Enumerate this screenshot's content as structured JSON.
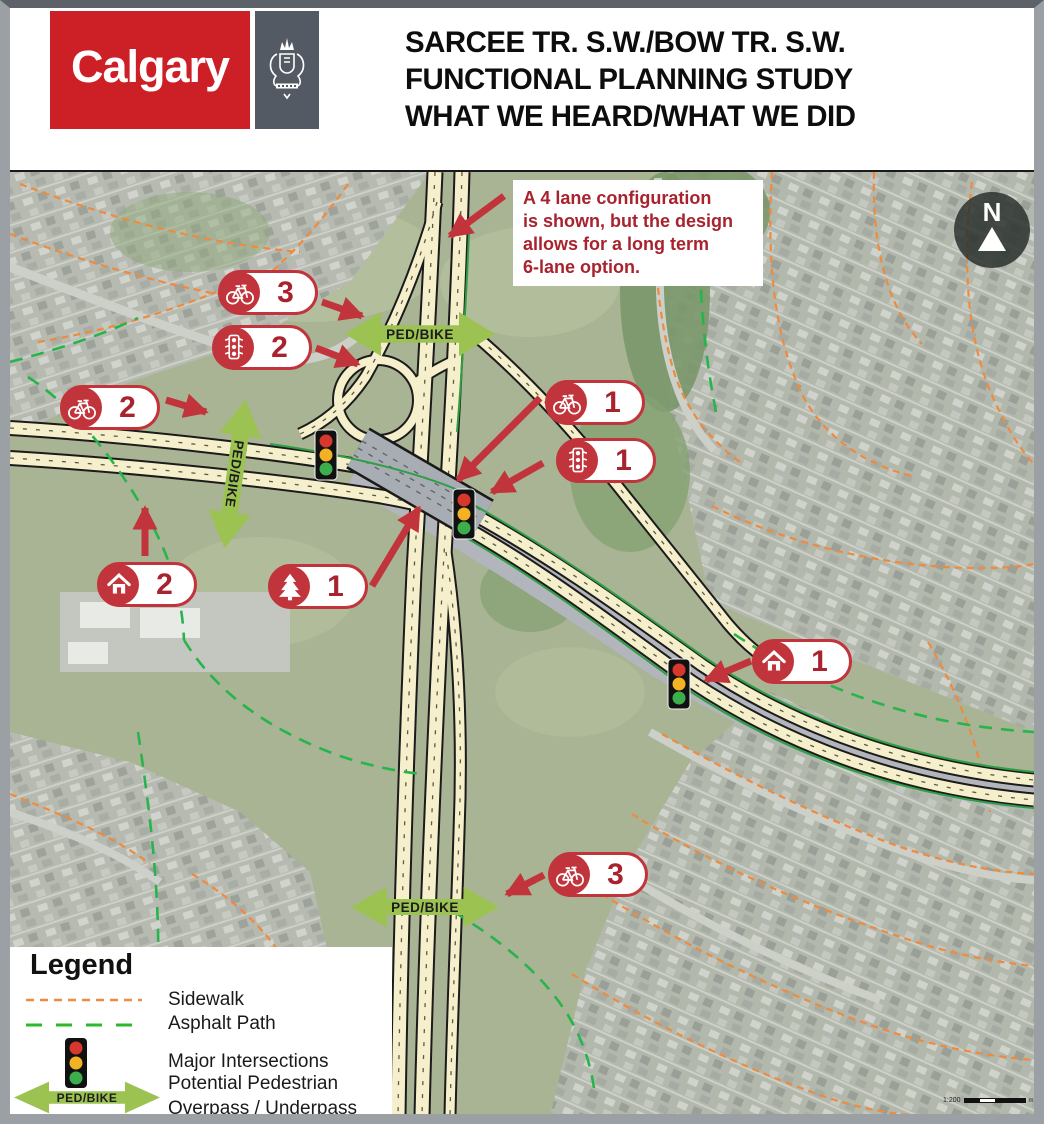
{
  "header": {
    "logo_text": "Calgary",
    "title": "SARCEE TR. S.W./BOW TR. S.W.\nFUNCTIONAL PLANNING STUDY\nWHAT WE HEARD/WHAT WE DID"
  },
  "map": {
    "callout_text": "A 4 lane configuration\nis shown, but the design\nallows for a long term\n6-lane option.",
    "north_label": "N",
    "ped_bike_label": "PED/BIKE",
    "markers": [
      {
        "type": "bike",
        "count": "3"
      },
      {
        "type": "traffic-signal",
        "count": "2"
      },
      {
        "type": "bike",
        "count": "2"
      },
      {
        "type": "home",
        "count": "2"
      },
      {
        "type": "tree",
        "count": "1"
      },
      {
        "type": "bike",
        "count": "1"
      },
      {
        "type": "traffic-signal",
        "count": "1"
      },
      {
        "type": "home",
        "count": "1"
      },
      {
        "type": "bike",
        "count": "3"
      }
    ],
    "scale": {
      "ratio": "1:200",
      "unit": "m"
    }
  },
  "legend": {
    "title": "Legend",
    "items": [
      {
        "label": "Sidewalk"
      },
      {
        "label": "Asphalt Path"
      },
      {
        "label": "Major Intersections"
      },
      {
        "label": "Potential Pedestrian\nOverpass / Underpass"
      }
    ],
    "arrow_label": "PED/BIKE"
  },
  "colors": {
    "brand_red": "#cd2026",
    "crest_slate": "#545a63",
    "annotation_red": "#c2343b",
    "number_red": "#a8232d",
    "ped_bike_green": "#9cc252",
    "sidewalk_orange": "#ef8a3e",
    "asphalt_path_green": "#2db24d",
    "road_cream": "#f6efcc",
    "signal_red": "#d6382e",
    "signal_amber": "#f2b224",
    "signal_green": "#3cae4c"
  }
}
